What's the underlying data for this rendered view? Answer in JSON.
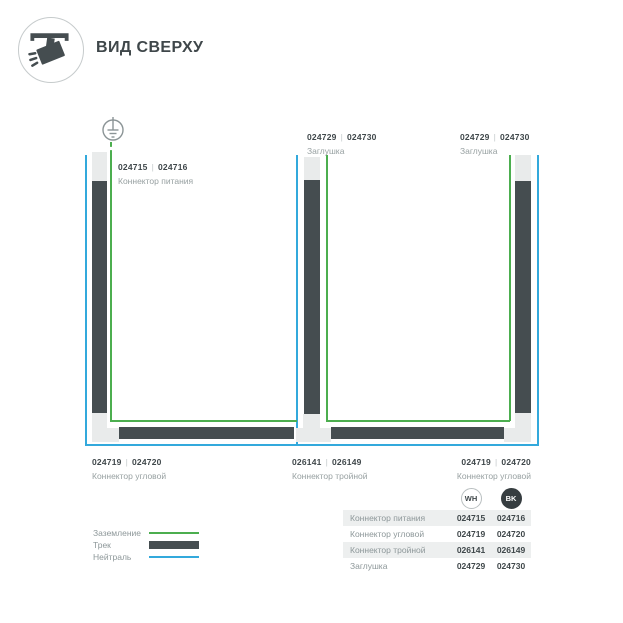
{
  "header": {
    "title": "ВИД СВЕРХУ"
  },
  "ui": {
    "divider": "|"
  },
  "colors": {
    "track": "#454d50",
    "connector": "#e9ebeb",
    "ground_green": "#4cae4f",
    "neutral_blue": "#33a9dc",
    "text_dark": "#3f474a",
    "text_gray": "#97a0a1"
  },
  "diagram": {
    "labels": [
      {
        "code_wh": "024715",
        "code_bk": "024716",
        "name": "Коннектор питания"
      },
      {
        "code_wh": "024729",
        "code_bk": "024730",
        "name": "Заглушка"
      },
      {
        "code_wh": "024729",
        "code_bk": "024730",
        "name": "Заглушка"
      },
      {
        "code_wh": "024719",
        "code_bk": "024720",
        "name": "Коннектор угловой"
      },
      {
        "code_wh": "026141",
        "code_bk": "026149",
        "name": "Коннектор тройной"
      },
      {
        "code_wh": "024719",
        "code_bk": "024720",
        "name": "Коннектор угловой"
      }
    ]
  },
  "legend": {
    "items": [
      {
        "label": "Заземление",
        "swatch": "green-line"
      },
      {
        "label": "Трек",
        "swatch": "track-bar"
      },
      {
        "label": "Нейтраль",
        "swatch": "blue-line"
      }
    ]
  },
  "table": {
    "columns": [
      {
        "label": "WH"
      },
      {
        "label": "BK"
      }
    ],
    "rows": [
      {
        "name": "Коннектор питания",
        "wh": "024715",
        "bk": "024716"
      },
      {
        "name": "Коннектор угловой",
        "wh": "024719",
        "bk": "024720"
      },
      {
        "name": "Коннектор тройной",
        "wh": "026141",
        "bk": "026149"
      },
      {
        "name": "Заглушка",
        "wh": "024729",
        "bk": "024730"
      }
    ]
  }
}
